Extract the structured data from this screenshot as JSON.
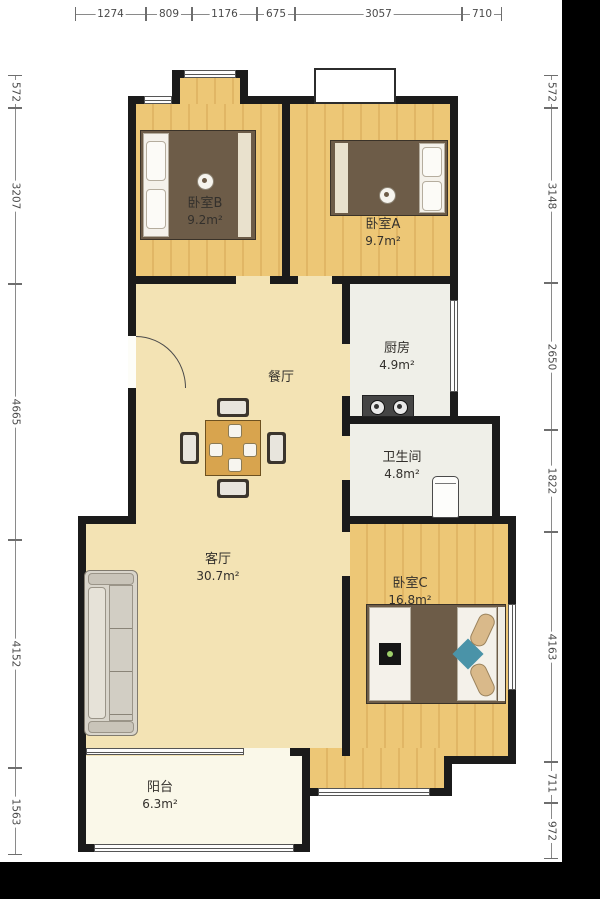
{
  "view": {
    "type": "apartment-floorplan-photo",
    "background_color": "#000000",
    "paper_color": "#ffffff"
  },
  "colors": {
    "wall": "#1b1b1b",
    "bedroom_floor": "#edc776",
    "hall_floor": "#f3e3b4",
    "service_floor": "#efefe8",
    "balcony_floor": "#faf8e9",
    "dimension_text": "#4a4a4a",
    "label_text": "#33302c",
    "bed_blanket": "#6d5c48",
    "teal_accent": "#4a93a8"
  },
  "dims": {
    "top": [
      "1274",
      "809",
      "1176",
      "675",
      "3057",
      "710"
    ],
    "left": [
      "572",
      "3207",
      "4665",
      "4152",
      "1563"
    ],
    "right": [
      "572",
      "3148",
      "2650",
      "1822",
      "4163",
      "711",
      "972"
    ]
  },
  "rooms": [
    {
      "id": "bedroom-b",
      "name": "卧室B",
      "area": "9.2m²"
    },
    {
      "id": "bedroom-a",
      "name": "卧室A",
      "area": "9.7m²"
    },
    {
      "id": "kitchen",
      "name": "厨房",
      "area": "4.9m²"
    },
    {
      "id": "dining",
      "name": "餐厅",
      "area": ""
    },
    {
      "id": "bathroom",
      "name": "卫生间",
      "area": "4.8m²"
    },
    {
      "id": "living",
      "name": "客厅",
      "area": "30.7m²"
    },
    {
      "id": "bedroom-c",
      "name": "卧室C",
      "area": "16.8m²"
    },
    {
      "id": "balcony",
      "name": "阳台",
      "area": "6.3m²"
    }
  ]
}
